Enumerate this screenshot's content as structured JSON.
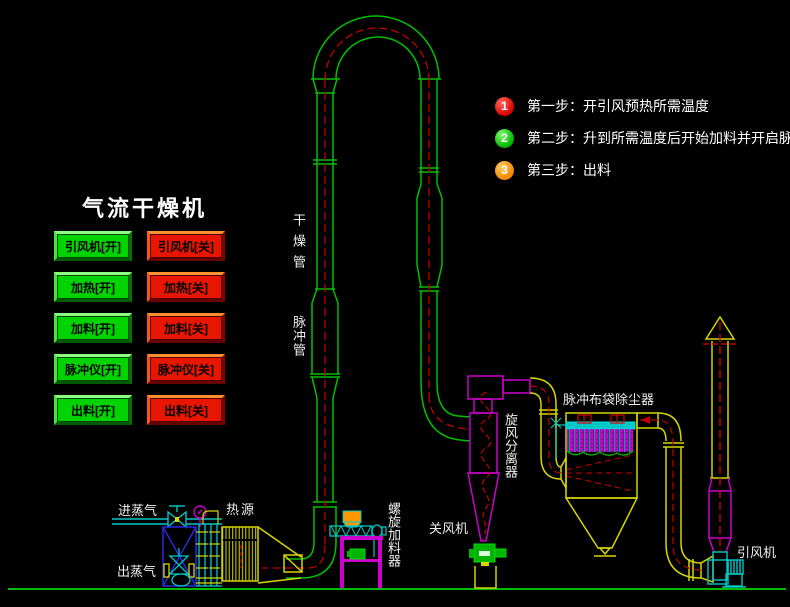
{
  "title": "气流干燥机",
  "controls": {
    "on_buttons": [
      {
        "label": "引风机[开]"
      },
      {
        "label": "加热[开]"
      },
      {
        "label": "加料[开]"
      },
      {
        "label": "脉冲仪[开]"
      },
      {
        "label": "出料[开]"
      }
    ],
    "off_buttons": [
      {
        "label": "引风机[关]"
      },
      {
        "label": "加热[关]"
      },
      {
        "label": "加料[关]"
      },
      {
        "label": "脉冲仪[关]"
      },
      {
        "label": "出料[关]"
      }
    ]
  },
  "steps": [
    {
      "num": "1",
      "text": "第一步：开引风预热所需温度",
      "color": "#d80000"
    },
    {
      "num": "2",
      "text": "第二步：升到所需温度后开始加料并开启脉冲仪",
      "color": "#00b400"
    },
    {
      "num": "3",
      "text": "第三步：出料",
      "color": "#f08800"
    }
  ],
  "labels": {
    "drying_pipe": "干燥管",
    "pulse_pipe": "脉冲管",
    "cyclone": "旋风分离器",
    "rotary_valve": "关风机",
    "bag_filter": "脉冲布袋除尘器",
    "induced_fan": "引风机",
    "steam_in": "进蒸气",
    "steam_out": "出蒸气",
    "heat_source": "热源",
    "screw_feeder": "螺旋加料器"
  },
  "colors": {
    "background": "#000000",
    "pipe_green": "#00c000",
    "centerline_red": "#c00000",
    "equipment_magenta": "#cc00cc",
    "duct_yellow": "#d6d600",
    "aux_cyan": "#00c8c8",
    "frame_blue": "#2828e0",
    "hopper_orange": "#ff9800",
    "button_on": "#00d400",
    "button_off": "#e81500",
    "ground": "#00bb00",
    "text": "#ffffff"
  }
}
